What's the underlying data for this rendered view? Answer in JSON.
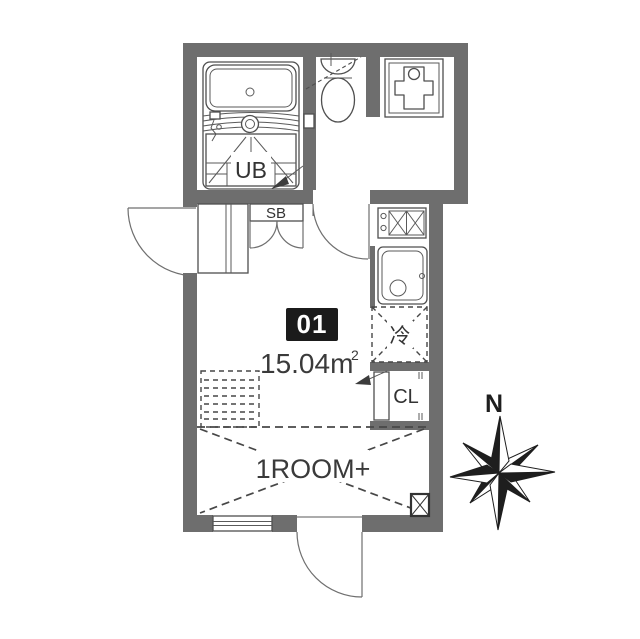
{
  "floor_plan": {
    "unit_number": "01",
    "area_value": "15.04m",
    "area_exponent": "2",
    "room_type_label": "1ROOM+",
    "labels": {
      "unit_bath": "UB",
      "shoe_box": "SB",
      "closet": "CL",
      "refrigerator": "冷",
      "north": "N"
    },
    "colors": {
      "wall": "#6e6e6e",
      "line": "#4f4f4f",
      "badge_background": "#1b1b1b",
      "badge_text": "#ffffff",
      "text": "#3a3a3a"
    }
  }
}
